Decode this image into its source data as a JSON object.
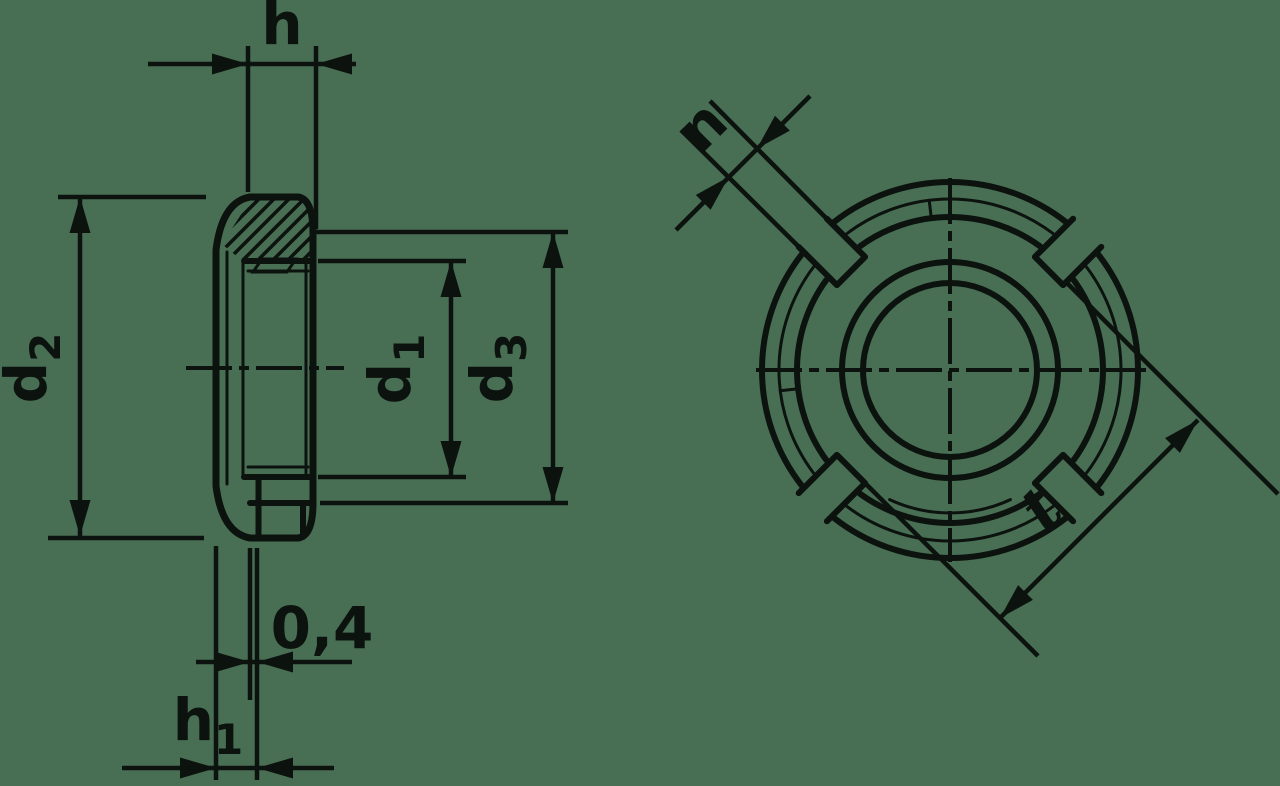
{
  "drawing": {
    "background_color": "#486e54",
    "ink_color": "#0c120e",
    "section_view": {
      "dim_h": {
        "main": "h"
      },
      "dim_d2": {
        "main": "d",
        "sub": "2"
      },
      "dim_d1": {
        "main": "d",
        "sub": "1"
      },
      "dim_d3": {
        "main": "d",
        "sub": "3"
      },
      "dim_step": {
        "main": "0,4"
      },
      "dim_h1": {
        "main": "h",
        "sub": "1"
      }
    },
    "front_view": {
      "dim_n": {
        "main": "n"
      },
      "dim_t": {
        "main": "t"
      }
    }
  }
}
